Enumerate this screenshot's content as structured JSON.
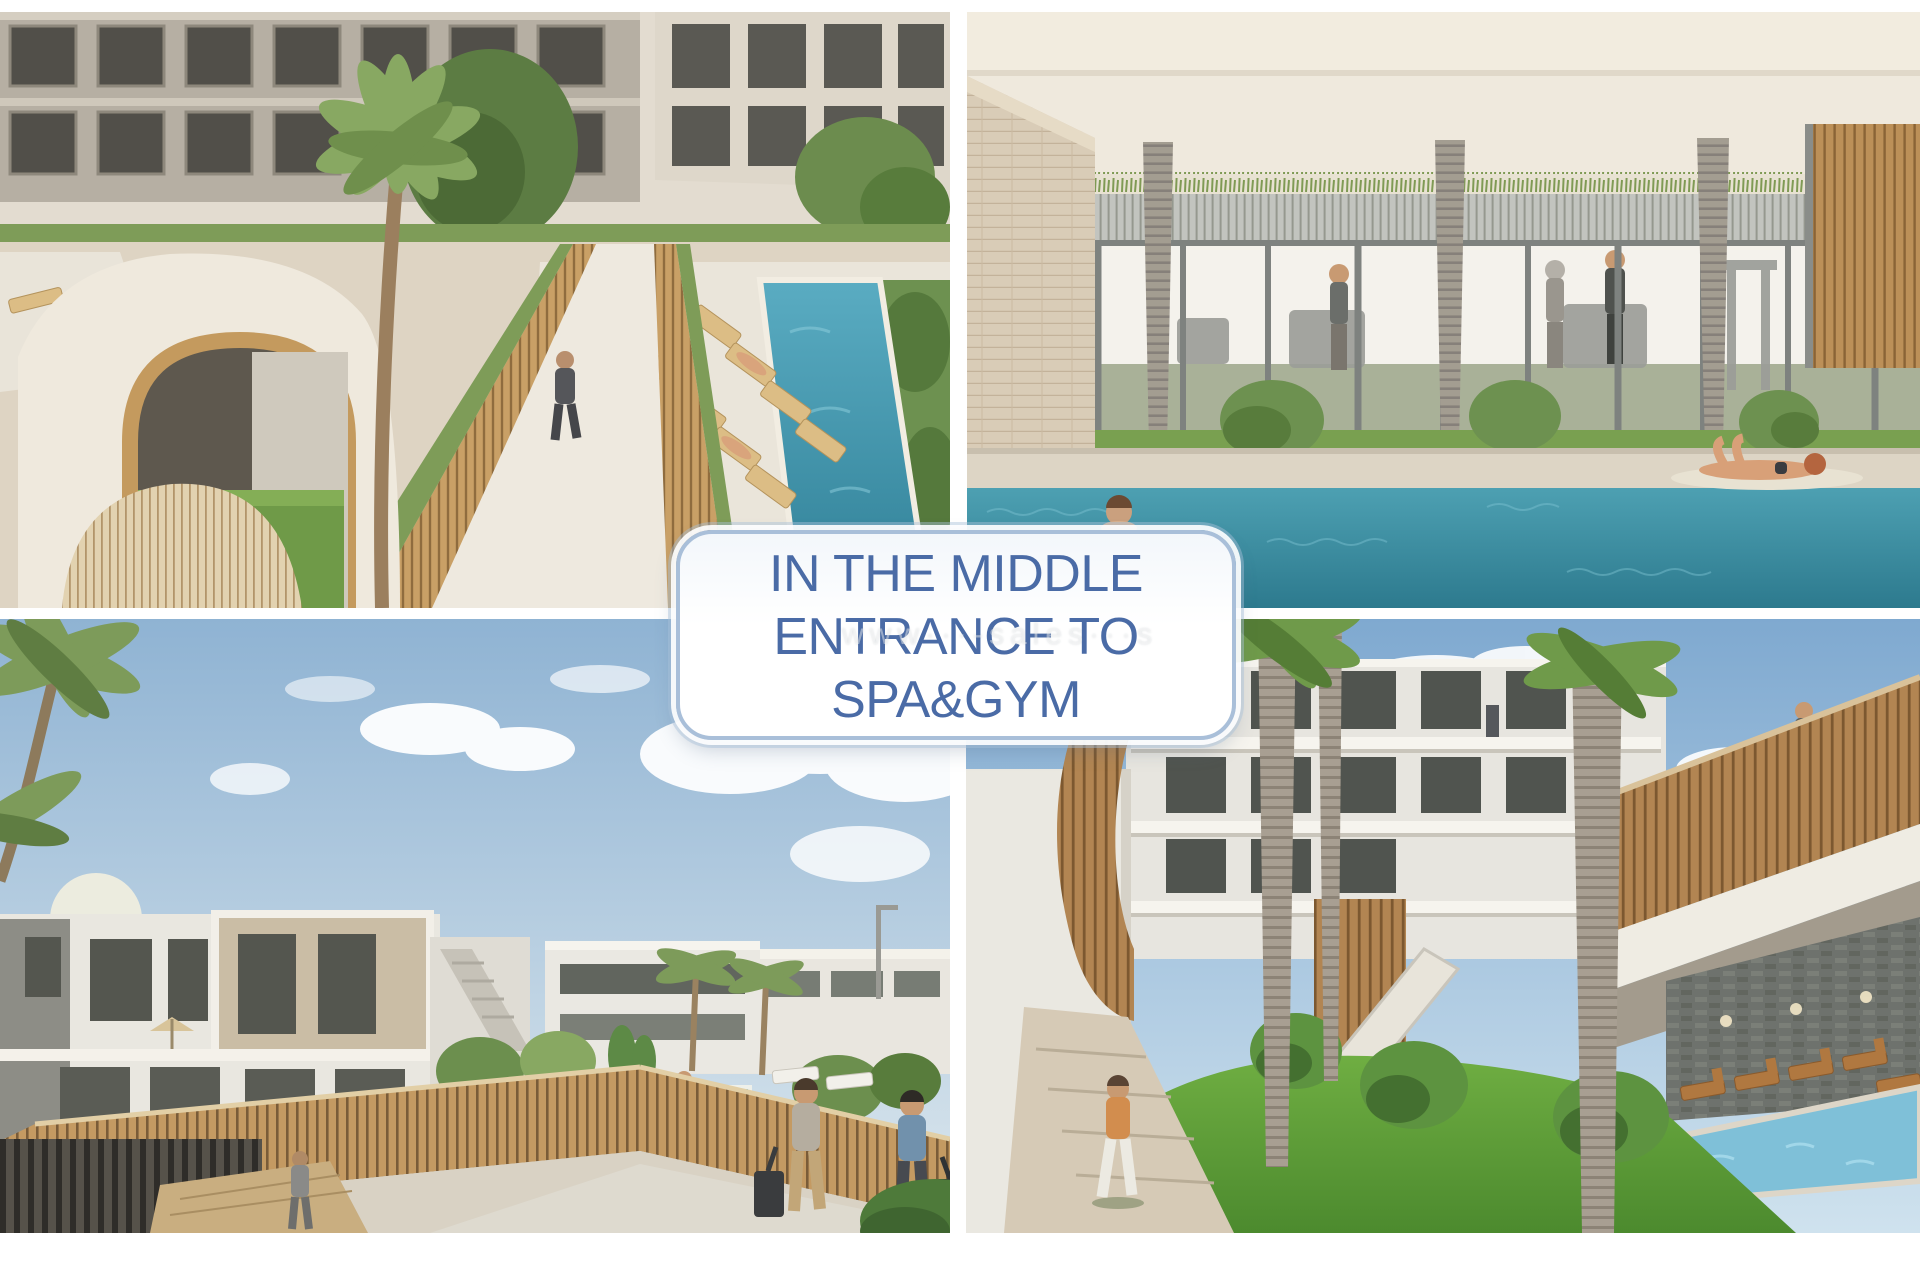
{
  "page": {
    "background_color": "#ffffff"
  },
  "overlay_box": {
    "lines": [
      "IN THE MIDDLE",
      "ENTRANCE TO",
      "SPA&GYM"
    ],
    "text_color": "#4a6ba6",
    "border_color": "#a9bfd9",
    "fill_color": "#ffffff"
  },
  "watermark": {
    "text": "www···-sales···s"
  },
  "collage": {
    "gutter_color": "#ffffff",
    "panels": [
      {
        "id": "spa-entrance-aerial-render",
        "position": "top-left"
      },
      {
        "id": "indoor-gym-pool-render",
        "position": "top-right"
      },
      {
        "id": "residential-street-pool-render",
        "position": "bottom-left"
      },
      {
        "id": "courtyard-garden-pool-render",
        "position": "bottom-right"
      }
    ],
    "key_colors": {
      "pool_teal": "#3d93a6",
      "lawn_green": "#5f9a3e",
      "wood_slat": "#c09a62",
      "facade_beige": "#b6afa3",
      "sky_blue": "#8fb3d3"
    }
  }
}
